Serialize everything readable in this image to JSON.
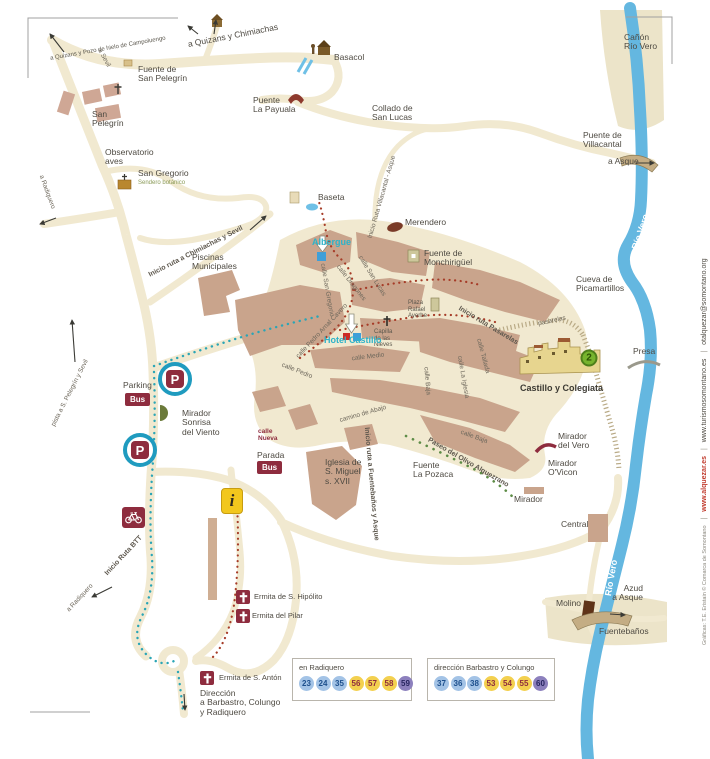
{
  "colors": {
    "road": "#f1e9d0",
    "block": "#c9a48c",
    "river": "#64b7e0",
    "badge_red": "#8e2c3e",
    "teal_accent": "#2db3c9",
    "info_yellow": "#f2c71d",
    "legend_blue": "#a3c3e6",
    "legend_yellow": "#f3d04f",
    "legend_purple": "#8c80bd",
    "poi_green": "#77b42e"
  },
  "labels": [
    {
      "n": "label-a-quizans-pozo",
      "t": "a Quizans y Pozo de hielo de Campoluengo",
      "x": 108,
      "y": 49,
      "r": -10,
      "a": "c",
      "c": "tiny"
    },
    {
      "n": "label-a-sevil",
      "t": "a Sevil",
      "x": 104,
      "y": 58,
      "r": 62,
      "a": "c",
      "c": "street"
    },
    {
      "n": "label-a-quizans-chimiachas",
      "t": "a Quizans y Chimiachas",
      "x": 233,
      "y": 36,
      "r": -11,
      "a": "c",
      "c": "lbl"
    },
    {
      "n": "label-basacol",
      "t": "Basacol",
      "x": 334,
      "y": 53,
      "c": "lbl"
    },
    {
      "n": "label-fuente-san-pelegrin",
      "t": "Fuente de\nSan Pelegrín",
      "x": 138,
      "y": 65,
      "c": "lbl"
    },
    {
      "n": "label-san-pelegrin",
      "t": "San\nPelegrín",
      "x": 92,
      "y": 110,
      "c": "lbl"
    },
    {
      "n": "label-puente-la-payuala",
      "t": "Puente\nLa Payuala",
      "x": 253,
      "y": 96,
      "c": "lbl"
    },
    {
      "n": "label-collado-san-lucas",
      "t": "Collado de\nSan Lucas",
      "x": 372,
      "y": 104,
      "c": "lbl"
    },
    {
      "n": "label-canon-rio-vero",
      "t": "Cañón\nRío Vero",
      "x": 624,
      "y": 33,
      "c": "lbl"
    },
    {
      "n": "label-puente-villacantal",
      "t": "Puente de\nVillacantal",
      "x": 583,
      "y": 131,
      "c": "lbl"
    },
    {
      "n": "label-a-asque",
      "t": "a Asque",
      "x": 608,
      "y": 157,
      "c": "lbl"
    },
    {
      "n": "label-observatorio-aves",
      "t": "Observatorio\naves",
      "x": 105,
      "y": 148,
      "c": "lbl"
    },
    {
      "n": "label-san-gregorio",
      "t": "San Gregorio",
      "x": 138,
      "y": 169,
      "c": "lbl"
    },
    {
      "n": "label-sendero-botanico",
      "t": "Sendero botánico",
      "x": 138,
      "y": 180,
      "c": "olive"
    },
    {
      "n": "label-a-radiquero-west",
      "t": "a Radiquero",
      "x": 47,
      "y": 192,
      "r": 70,
      "a": "c",
      "c": "street"
    },
    {
      "n": "label-inicio-ruta-chimiachas-sevil",
      "t": "Inicio ruta a Chimiachas y Sevil",
      "x": 196,
      "y": 252,
      "r": -27,
      "a": "c",
      "c": "route"
    },
    {
      "n": "label-piscinas-municipales",
      "t": "Piscinas\nMunicipales",
      "x": 192,
      "y": 253,
      "c": "lbl"
    },
    {
      "n": "label-baseta",
      "t": "Baseta",
      "x": 318,
      "y": 193,
      "c": "lbl"
    },
    {
      "n": "label-inicio-ruta-villacantal-asque",
      "t": "Inicio Ruta Villacantal - Asque",
      "x": 382,
      "y": 197,
      "r": -74,
      "a": "c",
      "c": "street"
    },
    {
      "n": "label-merendero",
      "t": "Merendero",
      "x": 405,
      "y": 218,
      "c": "lbl"
    },
    {
      "n": "label-albergue",
      "t": "Albergue",
      "x": 312,
      "y": 238,
      "c": "teal"
    },
    {
      "n": "label-fuente-monchiriguel",
      "t": "Fuente de\nMonchirigüel",
      "x": 424,
      "y": 249,
      "c": "lbl"
    },
    {
      "n": "label-calle-san-lucas",
      "t": "calle San Lucas",
      "x": 372,
      "y": 276,
      "r": 58,
      "a": "c",
      "c": "street"
    },
    {
      "n": "label-calle-dragones",
      "t": "calle Dragones",
      "x": 351,
      "y": 283,
      "r": 52,
      "a": "c",
      "c": "street"
    },
    {
      "n": "label-calle-san-gregorio",
      "t": "calle San Gregorio",
      "x": 327,
      "y": 290,
      "r": 80,
      "a": "c",
      "c": "street"
    },
    {
      "n": "label-plaza-rafael-ayerbe",
      "t": "Plaza\nRafael\nAyerbe",
      "x": 408,
      "y": 300,
      "c": "tiny"
    },
    {
      "n": "label-capilla-nieves",
      "t": "Capilla\nde las\nNieves",
      "x": 374,
      "y": 329,
      "c": "tiny"
    },
    {
      "n": "label-hotel-castillo",
      "t": "Hotel Castillo",
      "x": 324,
      "y": 336,
      "c": "teal"
    },
    {
      "n": "label-calle-medio",
      "t": "calle Medio",
      "x": 368,
      "y": 357,
      "r": -7,
      "a": "c",
      "c": "street"
    },
    {
      "n": "label-inicio-ruta-pasarelas",
      "t": "Inicio  ruta  Pasarelas",
      "x": 488,
      "y": 326,
      "r": 31,
      "a": "c",
      "c": "route"
    },
    {
      "n": "label-pasarelas",
      "t": "pasarelas",
      "x": 552,
      "y": 321,
      "r": -12,
      "a": "c",
      "c": "street"
    },
    {
      "n": "label-cueva-picamartillos",
      "t": "Cueva de\nPicamartillos",
      "x": 576,
      "y": 275,
      "c": "lbl"
    },
    {
      "n": "label-presa",
      "t": "Presa",
      "x": 633,
      "y": 347,
      "c": "lbl"
    },
    {
      "n": "label-rio-vero-top",
      "t": "Río Vero",
      "x": 641,
      "y": 232,
      "r": -72,
      "a": "c",
      "c": "riverlbl"
    },
    {
      "n": "label-rio-vero-bottom",
      "t": "Río Vero",
      "x": 612,
      "y": 578,
      "r": -80,
      "a": "c",
      "c": "riverlbl"
    },
    {
      "n": "label-castillo-colegiata",
      "t": "Castillo y Colegiata",
      "x": 520,
      "y": 384,
      "c": "boldlbl"
    },
    {
      "n": "label-calle-tallada",
      "t": "calle Tallada",
      "x": 483,
      "y": 356,
      "r": 75,
      "a": "c",
      "c": "street"
    },
    {
      "n": "label-calle-la-iglesia",
      "t": "calle La Iglesia",
      "x": 463,
      "y": 377,
      "r": 80,
      "a": "c",
      "c": "street"
    },
    {
      "n": "label-calle-baja-1",
      "t": "calle Baja",
      "x": 427,
      "y": 381,
      "r": 85,
      "a": "c",
      "c": "street"
    },
    {
      "n": "label-calle-baja-2",
      "t": "calle Baja",
      "x": 474,
      "y": 437,
      "r": 20,
      "a": "c",
      "c": "street"
    },
    {
      "n": "label-calle-pedro-arnal-cavero",
      "t": "calle Pedro Arnal Cavero",
      "x": 322,
      "y": 331,
      "r": -47,
      "a": "c",
      "c": "street"
    },
    {
      "n": "label-calle-pedro",
      "t": "calle Pedro",
      "x": 297,
      "y": 371,
      "r": 22,
      "a": "c",
      "c": "street"
    },
    {
      "n": "label-parking",
      "t": "Parking",
      "x": 123,
      "y": 381,
      "c": "lbl"
    },
    {
      "n": "label-mirador-sonrisa-viento",
      "t": "Mirador\nSonrisa\ndel Viento",
      "x": 182,
      "y": 409,
      "c": "lbl"
    },
    {
      "n": "label-calle-nueva",
      "t": "calle\nNueva",
      "x": 258,
      "y": 428,
      "c": "darkred"
    },
    {
      "n": "label-parada",
      "t": "Parada",
      "x": 257,
      "y": 451,
      "c": "lbl"
    },
    {
      "n": "label-iglesia-san-miguel",
      "t": "Iglesia de\nS. Miguel\ns. XVII",
      "x": 325,
      "y": 458,
      "c": "lbl"
    },
    {
      "n": "label-fuente-la-pozaca",
      "t": "Fuente\nLa Pozaca",
      "x": 413,
      "y": 461,
      "c": "lbl"
    },
    {
      "n": "label-paseo-olivo-alquezrano",
      "t": "Paseo del Olivo Alquezrano",
      "x": 468,
      "y": 463,
      "r": 30,
      "a": "c",
      "c": "route"
    },
    {
      "n": "label-mirador-del-vero",
      "t": "Mirador\ndel Vero",
      "x": 558,
      "y": 432,
      "c": "lbl"
    },
    {
      "n": "label-mirador-ovicon",
      "t": "Mirador\nO'Vicon",
      "x": 548,
      "y": 459,
      "c": "lbl"
    },
    {
      "n": "label-mirador",
      "t": "Mirador",
      "x": 514,
      "y": 495,
      "c": "lbl"
    },
    {
      "n": "label-central",
      "t": "Central",
      "x": 561,
      "y": 520,
      "c": "lbl"
    },
    {
      "n": "label-camino-de-abajo",
      "t": "camino de Abajo",
      "x": 363,
      "y": 414,
      "r": -16,
      "a": "c",
      "c": "street"
    },
    {
      "n": "label-inicio-ruta-fuentebanos",
      "t": "Inicio ruta a  Fuentebaños y Asque",
      "x": 371,
      "y": 484,
      "r": 85,
      "a": "c",
      "c": "route"
    },
    {
      "n": "label-inicio-ruta-btt",
      "t": "Inicio Ruta BTT",
      "x": 124,
      "y": 556,
      "r": -47,
      "a": "c",
      "c": "route"
    },
    {
      "n": "label-a-radiquero-south",
      "t": "a Radiquero",
      "x": 80,
      "y": 598,
      "r": -47,
      "a": "c",
      "c": "street"
    },
    {
      "n": "label-ermita-hipolito",
      "t": "Ermita de S. Hipólito",
      "x": 254,
      "y": 593,
      "c": "lbl-sm"
    },
    {
      "n": "label-ermita-pilar",
      "t": "Ermita del Pilar",
      "x": 252,
      "y": 612,
      "c": "lbl-sm"
    },
    {
      "n": "label-ermita-anton",
      "t": "Ermita de S. Antón",
      "x": 219,
      "y": 674,
      "c": "lbl-sm"
    },
    {
      "n": "label-direccion-barbastro",
      "t": "Dirección\na Barbastro, Colungo\ny Radiquero",
      "x": 200,
      "y": 689,
      "c": "lbl"
    },
    {
      "n": "label-molino",
      "t": "Molino",
      "x": 556,
      "y": 599,
      "c": "lbl"
    },
    {
      "n": "label-azud-a-asque",
      "t": "Azud\na Asque",
      "x": 643,
      "y": 584,
      "a": "r",
      "c": "lbl"
    },
    {
      "n": "label-fuentebanos",
      "t": "Fuentebaños",
      "x": 599,
      "y": 627,
      "c": "lbl"
    },
    {
      "n": "label-pista-pelegrin-sevil",
      "t": "pista a S. Pelegrín y Sevil",
      "x": 70,
      "y": 393,
      "r": -63,
      "a": "c",
      "c": "street"
    }
  ],
  "markers": [
    {
      "n": "parking-icon-north",
      "k": "p",
      "x": 175,
      "y": 379,
      "t": "P"
    },
    {
      "n": "parking-icon-south",
      "k": "p",
      "x": 140,
      "y": 450,
      "t": "P"
    },
    {
      "n": "bus-badge-parking",
      "k": "bus",
      "x": 125,
      "y": 393,
      "t": "Bus"
    },
    {
      "n": "bus-badge-parada",
      "k": "bus",
      "x": 257,
      "y": 461,
      "t": "Bus"
    },
    {
      "n": "bike-route-icon",
      "k": "bike",
      "x": 122,
      "y": 507
    },
    {
      "n": "info-office-icon",
      "k": "info",
      "x": 221,
      "y": 488,
      "t": "i"
    },
    {
      "n": "ermita-hipolito-icon",
      "k": "cross",
      "x": 236,
      "y": 590
    },
    {
      "n": "ermita-pilar-icon",
      "k": "cross",
      "x": 236,
      "y": 609
    },
    {
      "n": "ermita-anton-icon",
      "k": "cross",
      "x": 200,
      "y": 671
    },
    {
      "n": "poi-2-badge",
      "k": "g2",
      "x": 589,
      "y": 358,
      "t": "2"
    }
  ],
  "legend": {
    "boxes": [
      {
        "title": "en Radiquero",
        "stops": [
          {
            "num": "23",
            "color": "blue"
          },
          {
            "num": "24",
            "color": "blue"
          },
          {
            "num": "35",
            "color": "blue"
          },
          {
            "num": "56",
            "color": "yellow"
          },
          {
            "num": "57",
            "color": "yellow"
          },
          {
            "num": "58",
            "color": "yellow"
          },
          {
            "num": "59",
            "color": "purple"
          }
        ]
      },
      {
        "title": "dirección Barbastro y Colungo",
        "stops": [
          {
            "num": "37",
            "color": "blue"
          },
          {
            "num": "36",
            "color": "blue"
          },
          {
            "num": "38",
            "color": "blue"
          },
          {
            "num": "53",
            "color": "yellow"
          },
          {
            "num": "54",
            "color": "yellow"
          },
          {
            "num": "55",
            "color": "yellow"
          },
          {
            "num": "60",
            "color": "purple"
          }
        ]
      }
    ]
  },
  "sidebar": {
    "credits": "Gráficas: T.E. Eristain © Comarca de Somontano",
    "site1": "www.alquezar.es",
    "site2": "www.turismosomontano.es",
    "email": "otalquezar@somontano.org"
  }
}
